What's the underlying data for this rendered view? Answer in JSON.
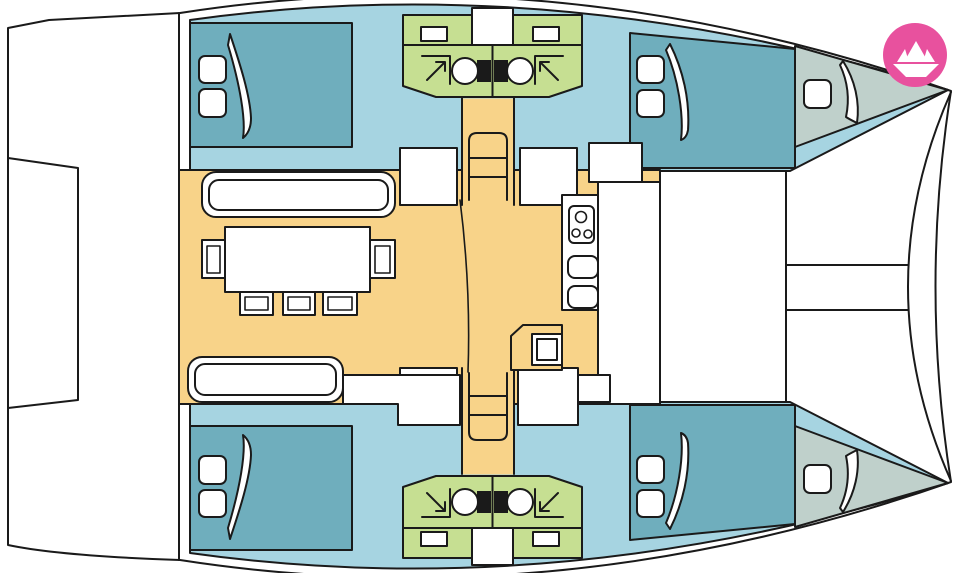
{
  "plan": {
    "type": "catamaran-deck-floor-plan",
    "orientation": "bow-right",
    "hulls": [
      {
        "position": "top",
        "rooms": [
          "aft-double-cabin",
          "two-bathrooms-with-shower-and-toilet",
          "forward-double-cabin",
          "forepeak-berth"
        ]
      },
      {
        "position": "bottom",
        "rooms": [
          "aft-double-cabin",
          "two-bathrooms-with-shower-and-toilet",
          "forward-double-cabin",
          "forepeak-berth"
        ]
      }
    ],
    "salon": {
      "furniture": [
        "forward-sofa",
        "dining-table",
        "two-end-chairs",
        "three-side-chairs",
        "aft-sofa",
        "galley-stove",
        "two-galley-sinks",
        "nav-seat"
      ],
      "companionways": 2
    },
    "aft": {
      "feature": "transom-steps-platform"
    },
    "foredeck": {
      "features": [
        "crossbeam-lines",
        "bow-bridle-lines"
      ]
    }
  },
  "colors": {
    "outline": "#1a1a1a",
    "deck_white": "#ffffff",
    "hull_deck": "#a6d4e1",
    "berth": "#6faebd",
    "wet_area": "#c6df92",
    "salon": "#f8d389",
    "forepeak": "#bfd0cb",
    "toilet_tank": "#1a1a1a",
    "logo_bg": "#e8519e",
    "logo_glyph": "#ffffff"
  },
  "logo": {
    "name": "paper-boat-logo",
    "shape": "origami-boat-in-circle"
  }
}
